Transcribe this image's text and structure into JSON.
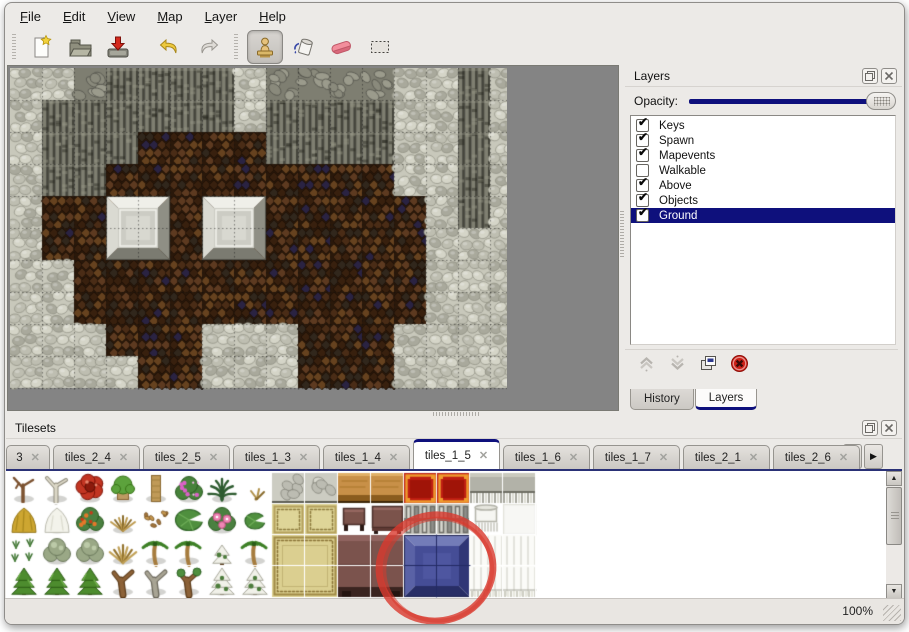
{
  "menu": {
    "items": [
      "File",
      "Edit",
      "View",
      "Map",
      "Layer",
      "Help"
    ]
  },
  "toolbar": {
    "buttons": [
      {
        "name": "new-file",
        "icon": "new-file-icon",
        "selected": false
      },
      {
        "name": "open",
        "icon": "open-folder-icon",
        "selected": false
      },
      {
        "name": "save",
        "icon": "save-icon",
        "selected": false
      },
      {
        "name": "undo",
        "icon": "undo-arrow-icon",
        "selected": false
      },
      {
        "name": "redo",
        "icon": "redo-arrow-icon",
        "selected": false
      },
      {
        "name": "stamp-tool",
        "icon": "stamp-icon",
        "selected": true
      },
      {
        "name": "fill-tool",
        "icon": "paint-bucket-icon",
        "selected": false
      },
      {
        "name": "eraser-tool",
        "icon": "eraser-icon",
        "selected": false
      },
      {
        "name": "select-tool",
        "icon": "selection-rect-icon",
        "selected": false
      }
    ]
  },
  "layers_panel": {
    "title": "Layers",
    "opacity_label": "Opacity:",
    "opacity_fraction": 1.0,
    "titlebar_icons": [
      "float-panel-icon",
      "close-panel-icon"
    ],
    "layers": [
      {
        "label": "Keys",
        "checked": true,
        "selected": false
      },
      {
        "label": "Spawn",
        "checked": true,
        "selected": false
      },
      {
        "label": "Mapevents",
        "checked": true,
        "selected": false
      },
      {
        "label": "Walkable",
        "checked": false,
        "selected": false
      },
      {
        "label": "Above",
        "checked": true,
        "selected": false
      },
      {
        "label": "Objects",
        "checked": true,
        "selected": false
      },
      {
        "label": "Ground",
        "checked": true,
        "selected": true
      }
    ],
    "action_icons": [
      "move-layer-up-icon",
      "move-layer-down-icon",
      "duplicate-layer-icon",
      "delete-layer-icon"
    ],
    "bottom_tabs": [
      {
        "label": "History",
        "active": false
      },
      {
        "label": "Layers",
        "active": true
      }
    ]
  },
  "tilesets_panel": {
    "title": "Tilesets",
    "titlebar_icons": [
      "float-panel-icon",
      "close-panel-icon"
    ],
    "close_glyph": "✕",
    "scroll_icons": [
      "scroll-tabs-left-icon",
      "scroll-tabs-right-icon"
    ],
    "tabs": [
      {
        "label": "3",
        "active": false,
        "truncated": true
      },
      {
        "label": "tiles_2_4",
        "active": false
      },
      {
        "label": "tiles_2_5",
        "active": false
      },
      {
        "label": "tiles_1_3",
        "active": false
      },
      {
        "label": "tiles_1_4",
        "active": false
      },
      {
        "label": "tiles_1_5",
        "active": true
      },
      {
        "label": "tiles_1_6",
        "active": false
      },
      {
        "label": "tiles_1_7",
        "active": false
      },
      {
        "label": "tiles_2_1",
        "active": false
      },
      {
        "label": "tiles_2_6",
        "active": false
      }
    ]
  },
  "map_view": {
    "tile_size": 32,
    "legend": {
      "L": "light-cobble-ground",
      "D": "dark-cliff-wall",
      "T": "cliff-rubble-top",
      "B": "brown-scale-ground",
      "P": "metal-platform"
    },
    "rows": [
      "LLTDDDDLTTTTLLDL",
      "LDDDDDDLDDDDLLDL",
      "LDDDBBBBDDDDLLDL",
      "LDDBBBBBBBBBLLDL",
      "LBBPPBPPBBBBBLDL",
      "LBBPPBPPBBBBBLLL",
      "LLBBBBBBBBBBBLLL",
      "LLBBBBBBBBBBBLLL",
      "LLLBBBLLLBBBLLLL",
      "LLLLBBLLLBBBLLLL"
    ],
    "platforms_px": [
      [
        96,
        128
      ],
      [
        192,
        128
      ]
    ]
  },
  "tileset_grid": {
    "tile_size": 32,
    "rows": [
      [
        "tree-dead-brown",
        "tree-dead-white",
        "flower-red-giant",
        "stump-mossy",
        "trunk-tan",
        "bush-pink-flowers",
        "fern-dark",
        "plant-dry-small",
        "stone-floor",
        "stone-floor",
        "table-wood",
        "table-wood",
        "carpet-red-gold",
        "carpet-red-gold",
        "bench-gray",
        "bench-gray"
      ],
      [
        "haystack",
        "snow-mound",
        "bush-orange-flowers",
        "grass-dry",
        "leaves-scatter",
        "lilypad-large",
        "flowers-pink",
        "lilypad-small",
        "carpet-tan",
        "carpet-tan",
        "stool-dark",
        "table-dark",
        "shelf-metal",
        "shelf-metal",
        "roll-white",
        "tile-white"
      ],
      [
        "sprigs-green",
        "bush-gray",
        "bush-gray",
        "tuft-dry",
        "palm-tree",
        "palm-tree",
        "pine-snow",
        "palm-tree",
        "carpet-tan2-tl",
        "carpet-tan2-tr",
        "couch-brown-tl",
        "couch-brown-tr",
        "tile-blue-tl",
        "tile-blue-tr",
        "curtain-white",
        "curtain-white"
      ],
      [
        "pine-green",
        "pine-green",
        "pine-green",
        "tree-gnarled-brown",
        "tree-gnarled-gray",
        "tree-gnarled-green",
        "pine-snowy",
        "pine-snowy",
        "carpet-tan2-bl",
        "carpet-tan2-br",
        "couch-brown-bl",
        "couch-brown-br",
        "tile-blue-bl",
        "tile-blue-br",
        "curtain-white-b",
        "curtain-white-b"
      ]
    ]
  },
  "annotation": {
    "shape": "ellipse",
    "description": "red hand-drawn circle around blue tile in tileset",
    "cx": 430,
    "cy": 151,
    "rx": 57,
    "ry": 53,
    "color": "#d93a2e",
    "stroke_width": 7
  },
  "statusbar": {
    "zoom": "100%"
  },
  "colors": {
    "accent_navy": "#0e107c",
    "selection_bg": "#0e107c",
    "annotation_red": "#d93a2e",
    "window_bg": "#eceae7",
    "canvas_gray": "#848484"
  }
}
